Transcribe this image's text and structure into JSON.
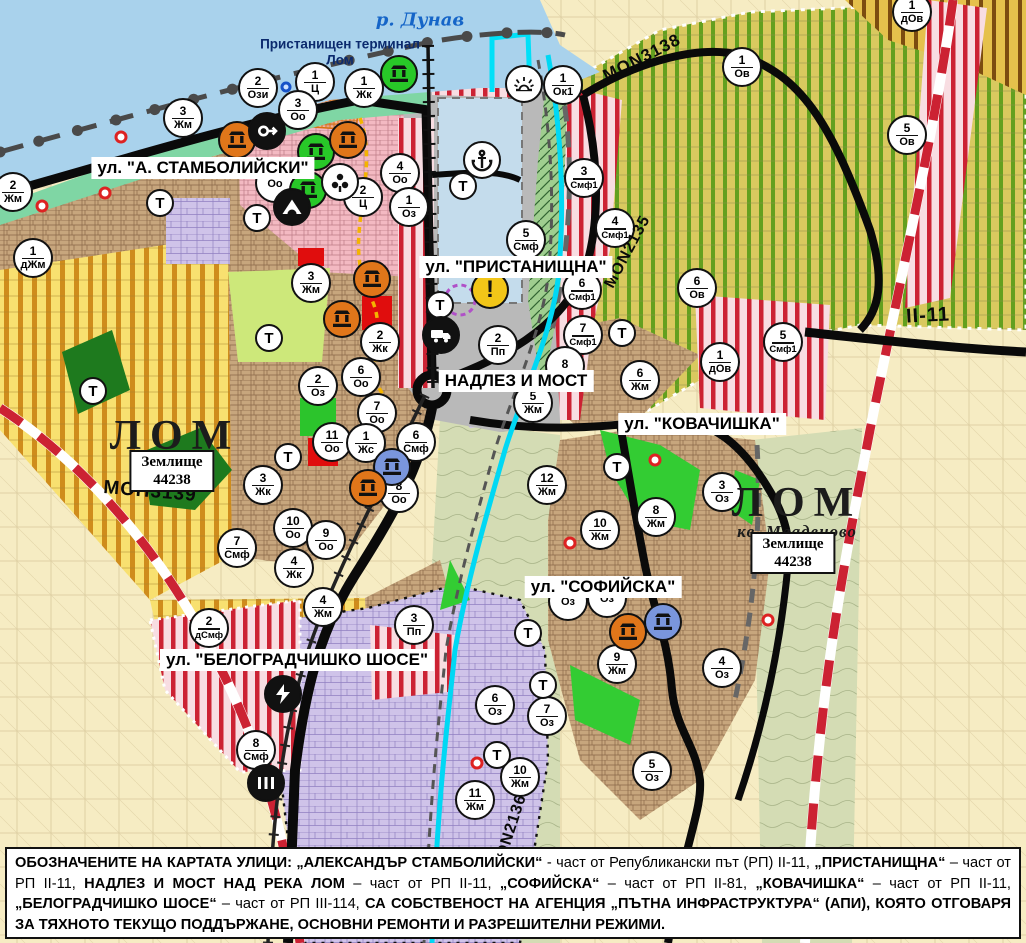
{
  "labels": {
    "river": "р. Дунав",
    "terminal": "Пристанищен терминал Лом",
    "t_circle": "Т"
  },
  "street_labels": [
    {
      "id": "stamboliyski",
      "text": "ул. \"А. СТАМБОЛИЙСКИ\"",
      "x": 203,
      "y": 168
    },
    {
      "id": "pristanishtna",
      "text": "ул. \"ПРИСТАНИЩНА\"",
      "x": 516,
      "y": 267
    },
    {
      "id": "nadlez-most",
      "text": "НАДЛЕЗ И МОСТ",
      "x": 516,
      "y": 381
    },
    {
      "id": "kovachishka",
      "text": "ул. \"КОВАЧИШКА\"",
      "x": 702,
      "y": 424
    },
    {
      "id": "sofiyska",
      "text": "ул. \"СОФИЙСКА\"",
      "x": 603,
      "y": 587
    },
    {
      "id": "belogradchishko",
      "text": "ул. \"БЕЛОГРАДЧИШКО ШОСЕ\"",
      "x": 297,
      "y": 660
    }
  ],
  "town_labels": [
    {
      "id": "lom-main",
      "title": "ЛОМ",
      "subtitle": "",
      "x": 175,
      "y": 436,
      "land_box": {
        "line1": "Землище",
        "line2": "44238",
        "x": 172,
        "y": 471
      }
    },
    {
      "id": "lom-mladenovo",
      "title": "ЛОМ",
      "subtitle": "кв. Младеново",
      "x": 797,
      "y": 512,
      "land_box": {
        "line1": "Землище",
        "line2": "44238",
        "x": 793,
        "y": 553
      }
    }
  ],
  "road_labels": [
    {
      "text": "MON3138",
      "x": 642,
      "y": 58,
      "angle": -27,
      "size": 17
    },
    {
      "text": "MON2135",
      "x": 628,
      "y": 252,
      "angle": -62,
      "size": 16
    },
    {
      "text": "МОН3139",
      "x": 150,
      "y": 492,
      "angle": 5,
      "size": 19
    },
    {
      "text": "MON2136",
      "x": 510,
      "y": 833,
      "angle": -72,
      "size": 16
    },
    {
      "text": "II-11",
      "x": 928,
      "y": 316,
      "angle": -3,
      "size": 20
    }
  ],
  "zone_circles": [
    {
      "n": "2",
      "c": "Ози",
      "x": 258,
      "y": 88
    },
    {
      "n": "1",
      "c": "Ц",
      "x": 315,
      "y": 82
    },
    {
      "n": "1",
      "c": "Жк",
      "x": 364,
      "y": 88
    },
    {
      "n": "3",
      "c": "Жм",
      "x": 183,
      "y": 118
    },
    {
      "n": "3",
      "c": "Оо",
      "x": 298,
      "y": 110
    },
    {
      "n": "2",
      "c": "Жм",
      "x": 13,
      "y": 192
    },
    {
      "n": "1",
      "c": "дЖм",
      "x": 33,
      "y": 258
    },
    {
      "n": "",
      "c": "Оо",
      "x": 275,
      "y": 183
    },
    {
      "n": "4",
      "c": "Оо",
      "x": 400,
      "y": 173
    },
    {
      "n": "2",
      "c": "Ц",
      "x": 363,
      "y": 197
    },
    {
      "n": "1",
      "c": "Оз",
      "x": 409,
      "y": 207
    },
    {
      "n": "3",
      "c": "Жм",
      "x": 311,
      "y": 283
    },
    {
      "n": "1",
      "c": "Ок1",
      "x": 563,
      "y": 85
    },
    {
      "n": "3",
      "c": "Смф1",
      "x": 584,
      "y": 178
    },
    {
      "n": "4",
      "c": "Смф1",
      "x": 615,
      "y": 228
    },
    {
      "n": "5",
      "c": "Смф",
      "x": 526,
      "y": 240
    },
    {
      "n": "6",
      "c": "Смф1",
      "x": 582,
      "y": 290
    },
    {
      "n": "7",
      "c": "Смф1",
      "x": 583,
      "y": 335
    },
    {
      "n": "2",
      "c": "Пп",
      "x": 498,
      "y": 345
    },
    {
      "n": "8",
      "c": "",
      "x": 565,
      "y": 366
    },
    {
      "n": "5",
      "c": "Жм",
      "x": 533,
      "y": 403
    },
    {
      "n": "6",
      "c": "Жм",
      "x": 640,
      "y": 380
    },
    {
      "n": "6",
      "c": "Ов",
      "x": 697,
      "y": 288
    },
    {
      "n": "1",
      "c": "дОв",
      "x": 720,
      "y": 362
    },
    {
      "n": "5",
      "c": "Смф1",
      "x": 783,
      "y": 342
    },
    {
      "n": "1",
      "c": "Ов",
      "x": 742,
      "y": 67
    },
    {
      "n": "5",
      "c": "Ов",
      "x": 907,
      "y": 135
    },
    {
      "n": "1",
      "c": "дОв",
      "x": 912,
      "y": 12
    },
    {
      "n": "2",
      "c": "Жк",
      "x": 380,
      "y": 342
    },
    {
      "n": "6",
      "c": "Оо",
      "x": 361,
      "y": 377
    },
    {
      "n": "2",
      "c": "Оз",
      "x": 318,
      "y": 386
    },
    {
      "n": "7",
      "c": "Оо",
      "x": 377,
      "y": 413
    },
    {
      "n": "11",
      "c": "Оо",
      "x": 332,
      "y": 442
    },
    {
      "n": "1",
      "c": "Жс",
      "x": 366,
      "y": 443
    },
    {
      "n": "6",
      "c": "Смф",
      "x": 416,
      "y": 442
    },
    {
      "n": "3",
      "c": "Жк",
      "x": 263,
      "y": 485
    },
    {
      "n": "8",
      "c": "Оо",
      "x": 399,
      "y": 493
    },
    {
      "n": "10",
      "c": "Оо",
      "x": 293,
      "y": 528
    },
    {
      "n": "9",
      "c": "Оо",
      "x": 326,
      "y": 540
    },
    {
      "n": "4",
      "c": "Жк",
      "x": 294,
      "y": 568
    },
    {
      "n": "4",
      "c": "Жм",
      "x": 323,
      "y": 607
    },
    {
      "n": "7",
      "c": "Смф",
      "x": 237,
      "y": 548
    },
    {
      "n": "2",
      "c": "дСмф",
      "x": 209,
      "y": 628
    },
    {
      "n": "3",
      "c": "Пп",
      "x": 414,
      "y": 625
    },
    {
      "n": "8",
      "c": "Смф",
      "x": 256,
      "y": 750
    },
    {
      "n": "11",
      "c": "Жм",
      "x": 475,
      "y": 800
    },
    {
      "n": "10",
      "c": "Жм",
      "x": 520,
      "y": 777
    },
    {
      "n": "7",
      "c": "Оз",
      "x": 547,
      "y": 716
    },
    {
      "n": "6",
      "c": "Оз",
      "x": 495,
      "y": 705
    },
    {
      "n": "5",
      "c": "Оз",
      "x": 652,
      "y": 771
    },
    {
      "n": "9",
      "c": "Жм",
      "x": 617,
      "y": 664
    },
    {
      "n": "4",
      "c": "Оз",
      "x": 722,
      "y": 668
    },
    {
      "n": "",
      "c": "Оз",
      "x": 568,
      "y": 601
    },
    {
      "n": "",
      "c": "Оз",
      "x": 607,
      "y": 598
    },
    {
      "n": "12",
      "c": "Жм",
      "x": 547,
      "y": 485
    },
    {
      "n": "10",
      "c": "Жм",
      "x": 600,
      "y": 530
    },
    {
      "n": "8",
      "c": "Жм",
      "x": 656,
      "y": 517
    },
    {
      "n": "3",
      "c": "Оз",
      "x": 722,
      "y": 492
    }
  ],
  "t_circles": [
    {
      "x": 160,
      "y": 203
    },
    {
      "x": 257,
      "y": 218
    },
    {
      "x": 93,
      "y": 391
    },
    {
      "x": 269,
      "y": 338
    },
    {
      "x": 288,
      "y": 457
    },
    {
      "x": 463,
      "y": 186
    },
    {
      "x": 440,
      "y": 305
    },
    {
      "x": 622,
      "y": 333
    },
    {
      "x": 617,
      "y": 467
    },
    {
      "x": 528,
      "y": 633
    },
    {
      "x": 543,
      "y": 685
    },
    {
      "x": 497,
      "y": 755
    }
  ],
  "icon_circles": [
    {
      "icon": "monument-icon",
      "variant": "orange",
      "x": 237,
      "y": 140
    },
    {
      "icon": "museum-key-icon",
      "variant": "black",
      "x": 267,
      "y": 131
    },
    {
      "icon": "monument-icon",
      "variant": "green",
      "x": 316,
      "y": 152
    },
    {
      "icon": "monument-icon",
      "variant": "orange",
      "x": 348,
      "y": 140
    },
    {
      "icon": "monument-icon",
      "variant": "green",
      "x": 308,
      "y": 190
    },
    {
      "icon": "trefoil-icon",
      "variant": "white",
      "x": 340,
      "y": 182
    },
    {
      "icon": "cave-icon",
      "variant": "black",
      "x": 292,
      "y": 207
    },
    {
      "icon": "monument-icon",
      "variant": "green",
      "x": 399,
      "y": 74
    },
    {
      "icon": "monument-icon",
      "variant": "orange",
      "x": 372,
      "y": 279
    },
    {
      "icon": "monument-icon",
      "variant": "orange",
      "x": 342,
      "y": 319
    },
    {
      "icon": "monument-icon",
      "variant": "blue",
      "x": 392,
      "y": 467
    },
    {
      "icon": "monument-icon",
      "variant": "orange",
      "x": 368,
      "y": 488
    },
    {
      "icon": "monument-icon",
      "variant": "orange",
      "x": 628,
      "y": 632
    },
    {
      "icon": "monument-icon",
      "variant": "blue",
      "x": 663,
      "y": 622
    },
    {
      "icon": "anchor-icon",
      "variant": "white",
      "x": 482,
      "y": 160
    },
    {
      "icon": "sun-icon",
      "variant": "white",
      "x": 524,
      "y": 84
    },
    {
      "icon": "warning-icon",
      "variant": "yellow",
      "x": 490,
      "y": 290
    },
    {
      "icon": "truck-icon",
      "variant": "black",
      "x": 441,
      "y": 335
    },
    {
      "icon": "lightning-icon",
      "variant": "black",
      "x": 283,
      "y": 694
    },
    {
      "icon": "rail-crossing-icon",
      "variant": "black",
      "x": 266,
      "y": 783
    }
  ],
  "markers": [
    {
      "kind": "red-dot",
      "x": 121,
      "y": 137
    },
    {
      "kind": "red-dot",
      "x": 105,
      "y": 193
    },
    {
      "kind": "red-dot",
      "x": 42,
      "y": 206
    },
    {
      "kind": "red-dot",
      "x": 655,
      "y": 460
    },
    {
      "kind": "red-dot",
      "x": 570,
      "y": 543
    },
    {
      "kind": "red-dot",
      "x": 477,
      "y": 763
    },
    {
      "kind": "red-dot",
      "x": 768,
      "y": 620
    },
    {
      "kind": "blue-ring",
      "x": 286,
      "y": 87
    }
  ],
  "note_segments": [
    {
      "t": "ОБОЗНАЧЕНИТЕ НА КАРТАТА УЛИЦИ: „АЛЕКСАНДЪР СТАМБОЛИЙСКИ“",
      "b": true
    },
    {
      "t": " - част от Републикански път (РП) II-11, ",
      "b": false
    },
    {
      "t": "„ПРИСТАНИЩНА“",
      "b": true
    },
    {
      "t": " – част от РП II-11, ",
      "b": false
    },
    {
      "t": "НАДЛЕЗ И МОСТ НАД РЕКА ЛОМ",
      "b": true
    },
    {
      "t": " – част от РП II-11, ",
      "b": false
    },
    {
      "t": "„СОФИЙСКА“",
      "b": true
    },
    {
      "t": " – част от РП II-81, ",
      "b": false
    },
    {
      "t": "„КОВАЧИШКА“",
      "b": true
    },
    {
      "t": " – част от РП II-11, ",
      "b": false
    },
    {
      "t": "„БЕЛОГРАДЧИШКО ШОСЕ“",
      "b": true
    },
    {
      "t": " – част от РП III-114, ",
      "b": false
    },
    {
      "t": "СА СОБСТВЕНОСТ НА АГЕНЦИЯ „ПЪТНА ИНФРАСТРУКТУРА“ (АПИ), КОЯТО ОТГОВАРЯ ЗА ТЯХНОТО ТЕКУЩО ПОДДЪРЖАНЕ, ОСНОВНИ РЕМОНТИ И РАЗРЕШИТЕЛНИ РЕЖИМИ.",
      "b": true
    }
  ],
  "colors": {
    "water": "#a9d2ec",
    "port_basin": "#c4dcec",
    "road": "#0a0a0a",
    "boundary_red": "#cc2233",
    "river_channel": "#00d8f4",
    "monument_orange": "#e0761a",
    "monument_green": "#28c828",
    "monument_blue": "#7a96dc",
    "warning_yellow": "#f2c618",
    "shore_green": "#7fd6a4"
  }
}
